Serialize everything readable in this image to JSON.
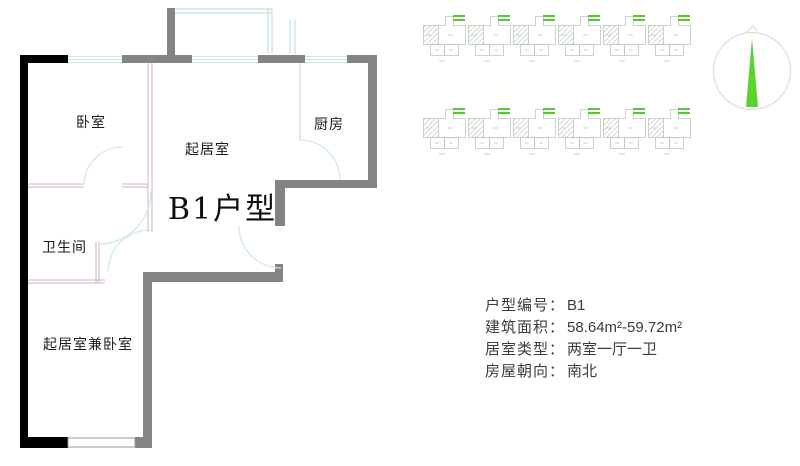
{
  "floorplan": {
    "title": "B1户型",
    "rooms": {
      "bedroom": "卧室",
      "living": "起居室",
      "kitchen": "厨房",
      "bathroom": "卫生间",
      "living_bedroom": "起居室兼卧室"
    }
  },
  "info": {
    "fields": [
      {
        "label": "户型编号：",
        "value": "B1"
      },
      {
        "label": "建筑面积：",
        "value": "58.64m²-59.72m²"
      },
      {
        "label": "居室类型：",
        "value": "两室一厅一卫"
      },
      {
        "label": "房屋朝向：",
        "value": "南北"
      }
    ]
  },
  "compass": {
    "icon": "north-compass",
    "needle_color": "#5ad32e"
  },
  "site_plan": {
    "icon": "building-key-plan",
    "rows": 2,
    "units_per_row": 6,
    "highlight_color": "#56c832",
    "line_color": "#bcc9bc"
  },
  "colors": {
    "wall_black": "#000000",
    "wall_gray": "#848484",
    "partition_pink": "#ccb3cc",
    "window_cyan": "#c9e8e8",
    "text": "#3c3c3c"
  }
}
